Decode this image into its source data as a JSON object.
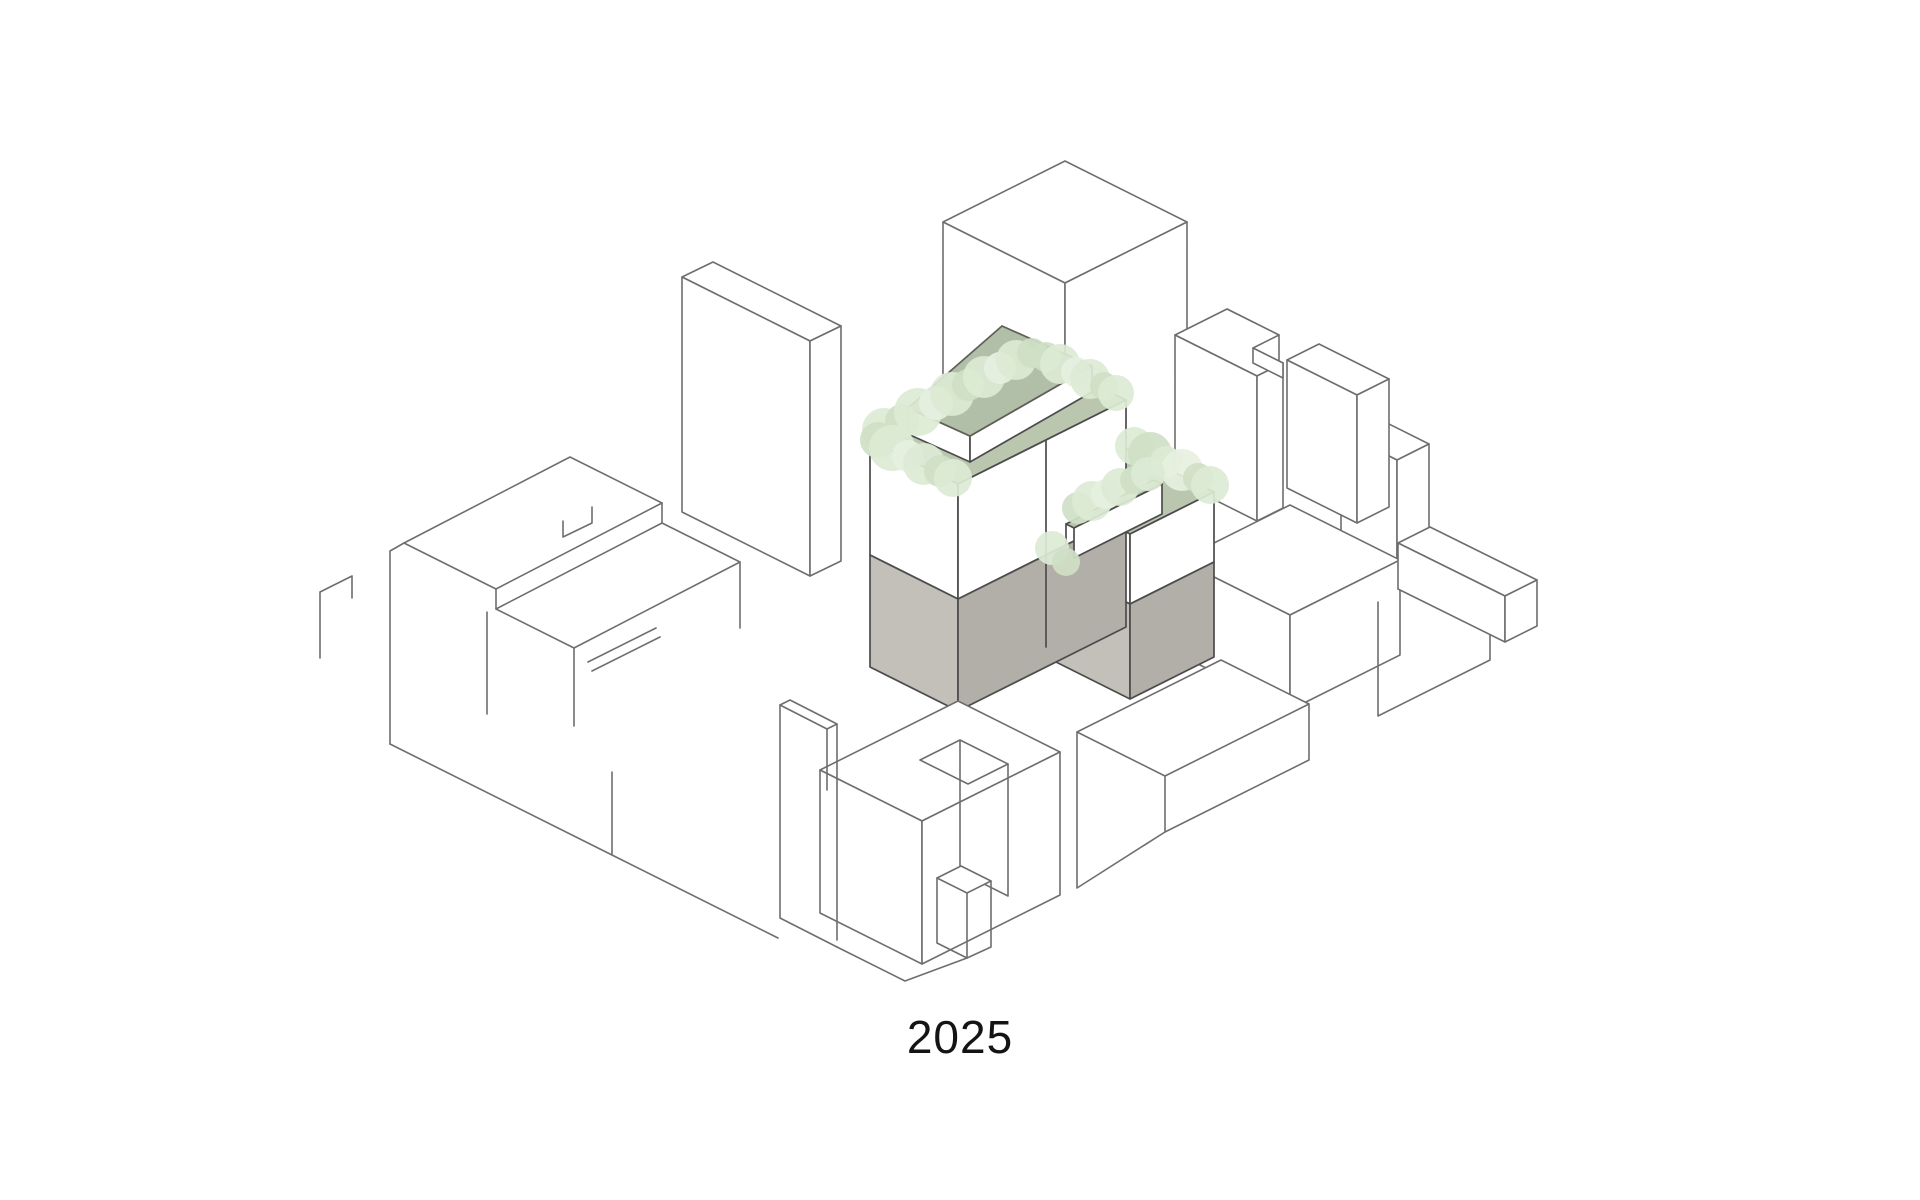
{
  "caption": {
    "text": "2025"
  },
  "colors": {
    "background": "#ffffff",
    "line": "#6e6e6e",
    "line_dark": "#4c4c4c",
    "roof_sage": "#b2bfa8",
    "sage_edge": "#5f5f57",
    "deck_green": "#bac7ae",
    "parapet_green": "#b7c4ab",
    "tree_light": "#dcead5",
    "tree_mid": "#cfe0c6",
    "tree_pale": "#e6f0df",
    "base_gray_light": "#c3c0b9",
    "base_gray_dark": "#b2afa8",
    "text": "#141414"
  },
  "icons": [
    {
      "name": "tree-icon",
      "glyph": "circle",
      "meaning": "roof terrace tree"
    }
  ],
  "trees": [
    {
      "x": 884,
      "y": 430,
      "r": 22,
      "s": 0
    },
    {
      "x": 902,
      "y": 421,
      "r": 17,
      "s": 1
    },
    {
      "x": 918,
      "y": 412,
      "r": 24,
      "s": 0
    },
    {
      "x": 936,
      "y": 403,
      "r": 17,
      "s": 2
    },
    {
      "x": 952,
      "y": 394,
      "r": 22,
      "s": 0
    },
    {
      "x": 968,
      "y": 385,
      "r": 16,
      "s": 1
    },
    {
      "x": 984,
      "y": 377,
      "r": 21,
      "s": 0
    },
    {
      "x": 1000,
      "y": 368,
      "r": 16,
      "s": 2
    },
    {
      "x": 1016,
      "y": 360,
      "r": 20,
      "s": 0
    },
    {
      "x": 1032,
      "y": 353,
      "r": 15,
      "s": 1
    },
    {
      "x": 878,
      "y": 440,
      "r": 18,
      "s": 1
    },
    {
      "x": 892,
      "y": 448,
      "r": 23,
      "s": 0
    },
    {
      "x": 908,
      "y": 456,
      "r": 16,
      "s": 2
    },
    {
      "x": 924,
      "y": 464,
      "r": 21,
      "s": 0
    },
    {
      "x": 940,
      "y": 471,
      "r": 16,
      "s": 1
    },
    {
      "x": 953,
      "y": 478,
      "r": 19,
      "s": 0
    },
    {
      "x": 1046,
      "y": 357,
      "r": 15,
      "s": 1
    },
    {
      "x": 1060,
      "y": 364,
      "r": 20,
      "s": 0
    },
    {
      "x": 1076,
      "y": 372,
      "r": 15,
      "s": 2
    },
    {
      "x": 1090,
      "y": 379,
      "r": 20,
      "s": 0
    },
    {
      "x": 1104,
      "y": 386,
      "r": 14,
      "s": 1
    },
    {
      "x": 1116,
      "y": 393,
      "r": 18,
      "s": 0
    },
    {
      "x": 1134,
      "y": 446,
      "r": 19,
      "s": 0
    },
    {
      "x": 1150,
      "y": 454,
      "r": 22,
      "s": 1
    },
    {
      "x": 1166,
      "y": 462,
      "r": 16,
      "s": 0
    },
    {
      "x": 1182,
      "y": 470,
      "r": 21,
      "s": 2
    },
    {
      "x": 1198,
      "y": 478,
      "r": 15,
      "s": 1
    },
    {
      "x": 1210,
      "y": 485,
      "r": 19,
      "s": 0
    },
    {
      "x": 1078,
      "y": 508,
      "r": 16,
      "s": 1
    },
    {
      "x": 1092,
      "y": 501,
      "r": 20,
      "s": 0
    },
    {
      "x": 1106,
      "y": 494,
      "r": 15,
      "s": 2
    },
    {
      "x": 1120,
      "y": 487,
      "r": 19,
      "s": 0
    },
    {
      "x": 1134,
      "y": 480,
      "r": 14,
      "s": 1
    },
    {
      "x": 1148,
      "y": 474,
      "r": 17,
      "s": 0
    },
    {
      "x": 1052,
      "y": 548,
      "r": 17,
      "s": 0
    },
    {
      "x": 1066,
      "y": 562,
      "r": 14,
      "s": 1
    }
  ]
}
